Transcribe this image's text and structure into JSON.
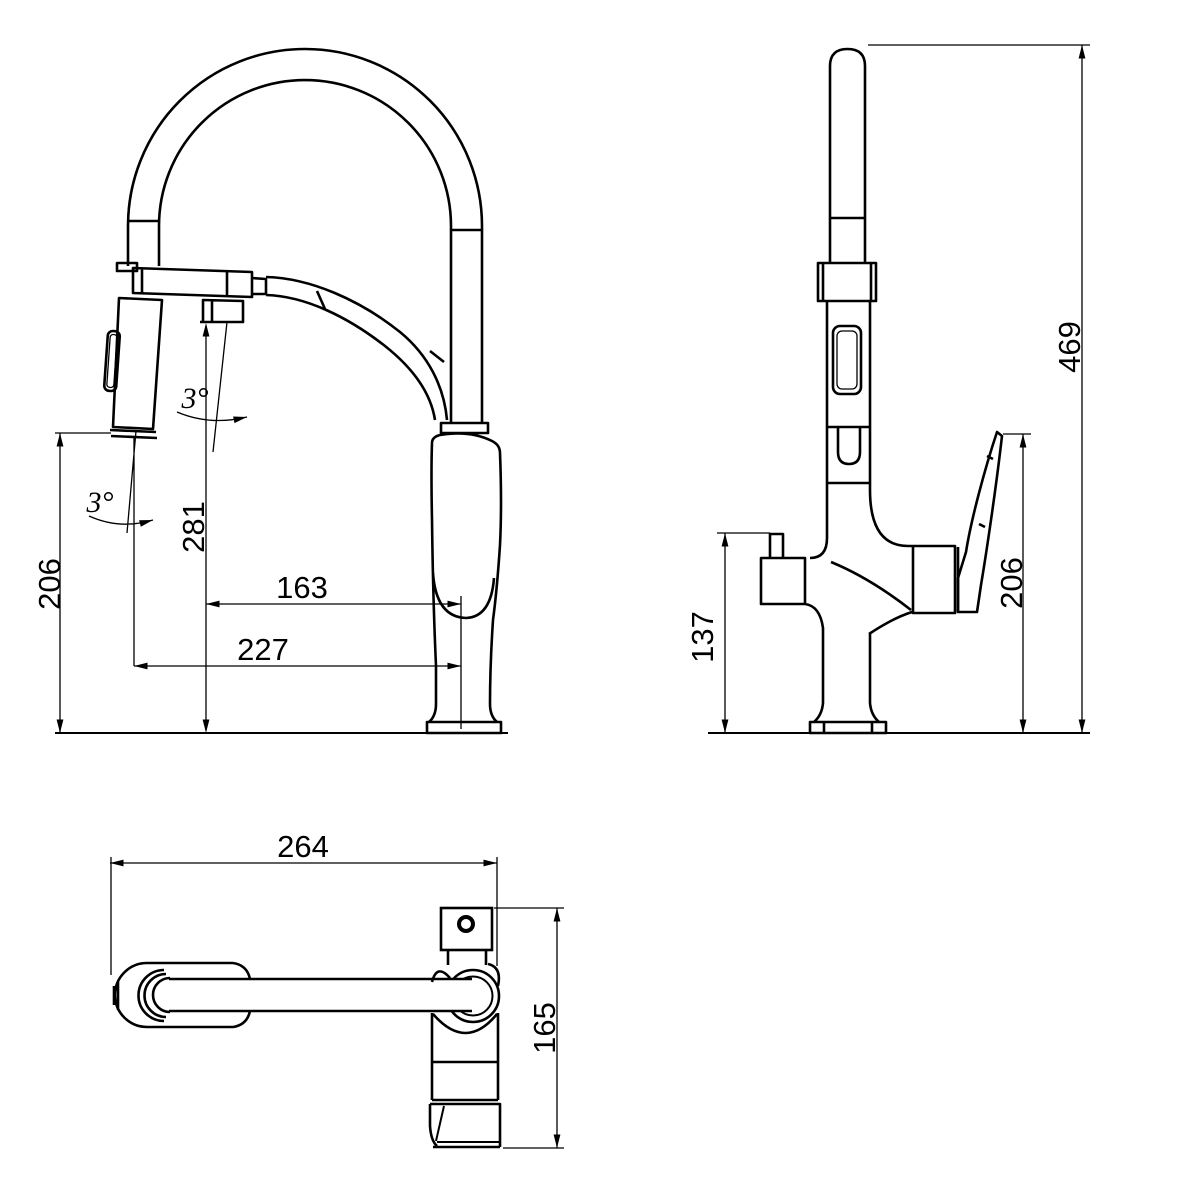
{
  "drawing_title": "Kitchen pull-down faucet dimensional drawing",
  "colors": {
    "line": "#000000",
    "background": "#ffffff"
  },
  "views": {
    "front": {
      "dimensions": {
        "outlet_height": "206",
        "hose_drop_height": "281",
        "spout_offset": "163",
        "spray_offset": "227",
        "spray_angle": "3°",
        "hose_angle": "3°"
      }
    },
    "side": {
      "dimensions": {
        "total_height": "469",
        "handle_height": "206",
        "bracket_height": "137"
      }
    },
    "top": {
      "dimensions": {
        "spout_reach": "264",
        "body_depth": "165"
      }
    }
  }
}
